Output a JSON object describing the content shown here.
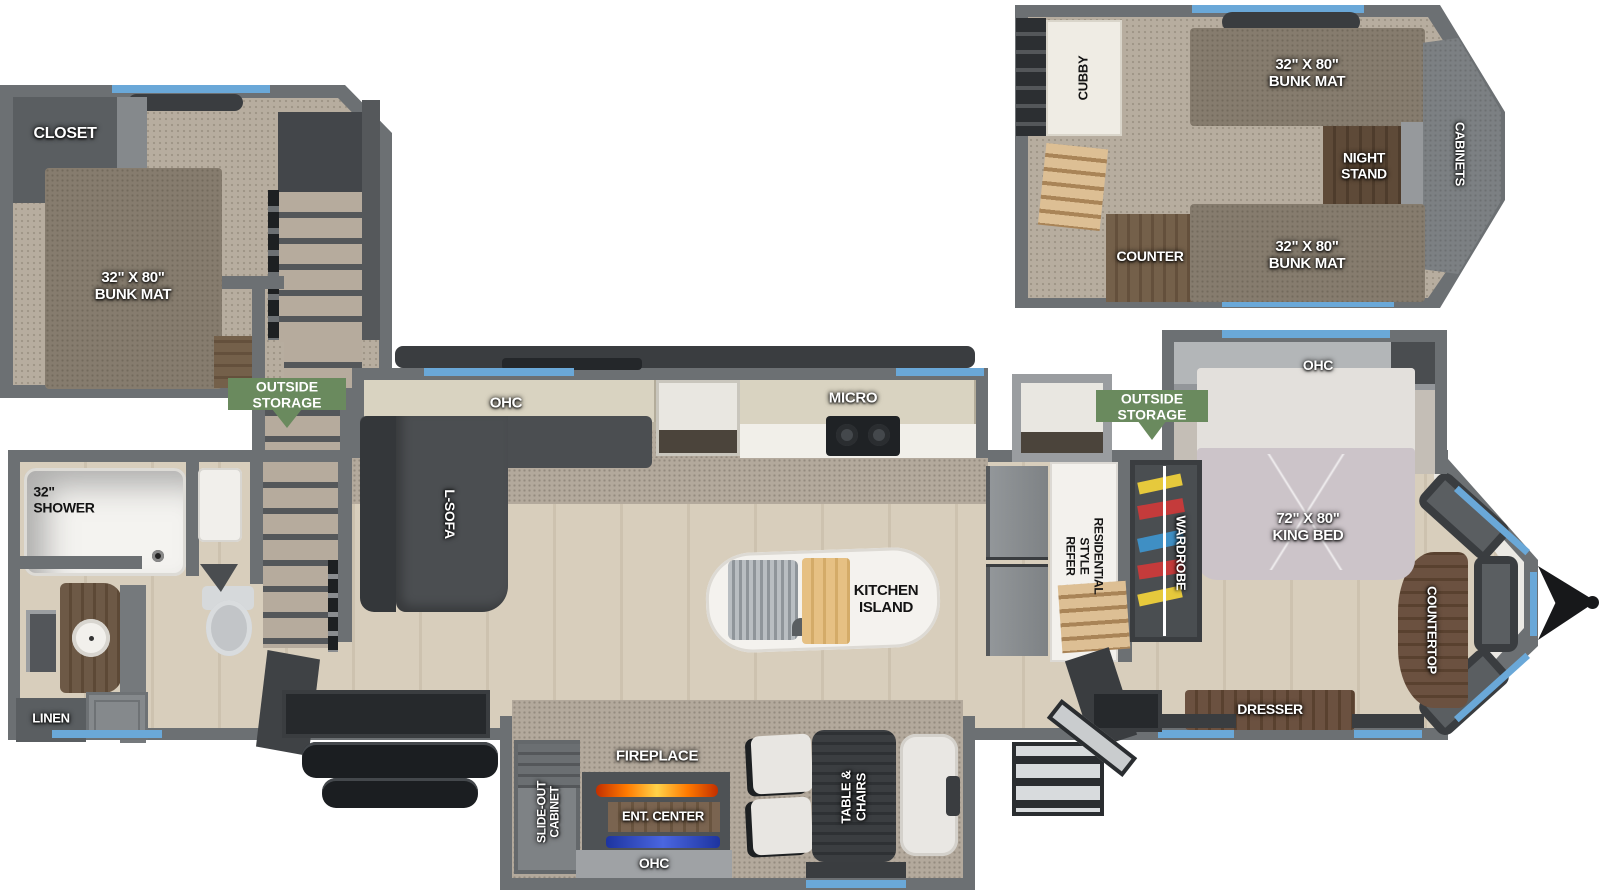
{
  "title": "RV / destination trailer floor plan diagram",
  "labels": {
    "closet": "CLOSET",
    "bunk_left": "32\" X 80\"\nBUNK MAT",
    "outside_storage": "OUTSIDE\nSTORAGE",
    "cubby": "CUBBY",
    "bunk_right_top": "32\" X 80\"\nBUNK MAT",
    "night_stand": "NIGHT\nSTAND",
    "cabinets": "CABINETS",
    "counter": "COUNTER",
    "bunk_right_bottom": "32\" X 80\"\nBUNK MAT",
    "shower": "32\"\nSHOWER",
    "linen": "LINEN",
    "ohc": "OHC",
    "l_sofa": "L-SOFA",
    "micro": "MICRO",
    "kitchen_island": "KITCHEN\nISLAND",
    "refer": "RESIDENTIAL\nSTYLE\nREFER",
    "wardrobe": "WARDROBE",
    "king_bed": "72\" X 80\"\nKING BED",
    "countertop": "COUNTERTOP",
    "dresser": "DRESSER",
    "slide_out_cabinet": "SLIDE-OUT\nCABINET",
    "fireplace": "FIREPLACE",
    "ent_center": "ENT. CENTER",
    "table_chairs": "TABLE &\nCHAIRS"
  },
  "colors": {
    "wall_gray": "#6c7073",
    "window_blue": "#6aa8d8",
    "badge_green": "#6a8a5e",
    "carpet": "#b7ad9f",
    "wood_floor": "#d8cebc",
    "dark_wood": "#6b5643",
    "mattress": "#ccc4c9",
    "flame_orange": "#ff7a00",
    "ent_led_blue": "#2f4fc0"
  }
}
